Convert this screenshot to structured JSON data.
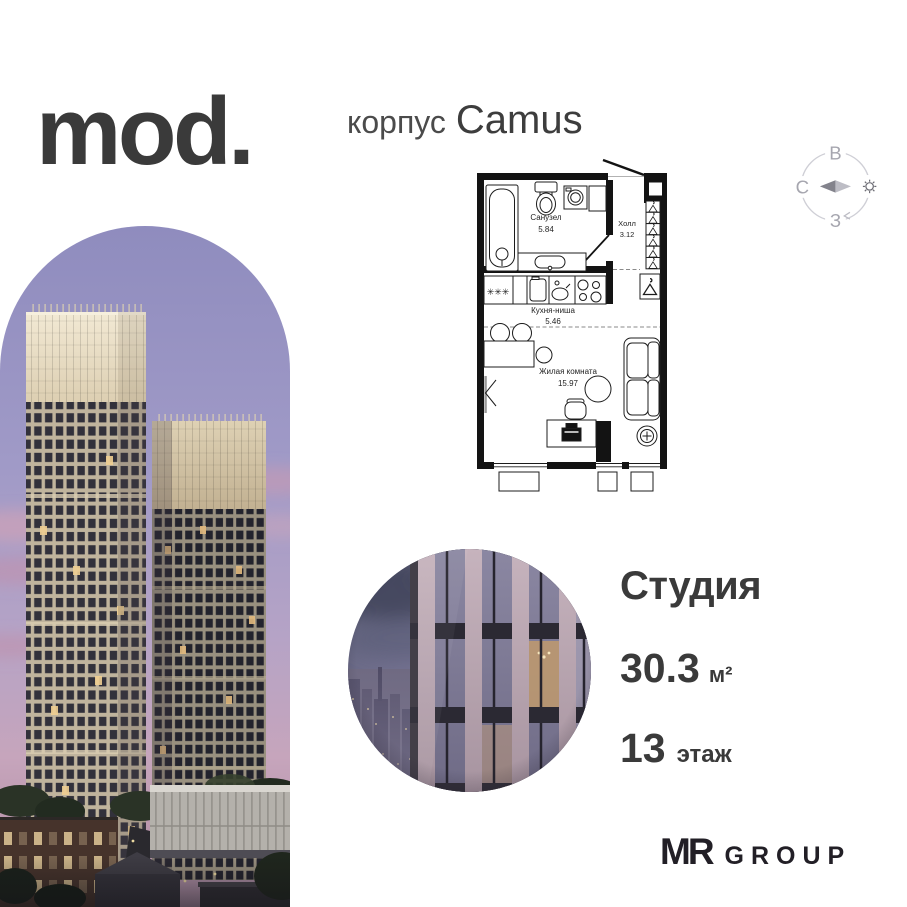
{
  "brand": {
    "logo": "mod."
  },
  "header": {
    "korpus_label": "корпус",
    "korpus_name": "Camus"
  },
  "compass": {
    "east": "В",
    "north": "С",
    "west": "З"
  },
  "floor_plan": {
    "rooms": [
      {
        "name": "Санузел",
        "area": "5.84"
      },
      {
        "name": "Холл",
        "area": "3.12"
      },
      {
        "name": "Кухня-ниша",
        "area": "5.46"
      },
      {
        "name": "Жилая комната",
        "area": "15.97"
      }
    ],
    "kitchen_marks": "✳✳✳"
  },
  "unit": {
    "type": "Студия",
    "area_value": "30.3",
    "area_unit": "м²",
    "floor_value": "13",
    "floor_unit": "этаж"
  },
  "developer": {
    "mr": "MR",
    "group": "GROUP"
  }
}
